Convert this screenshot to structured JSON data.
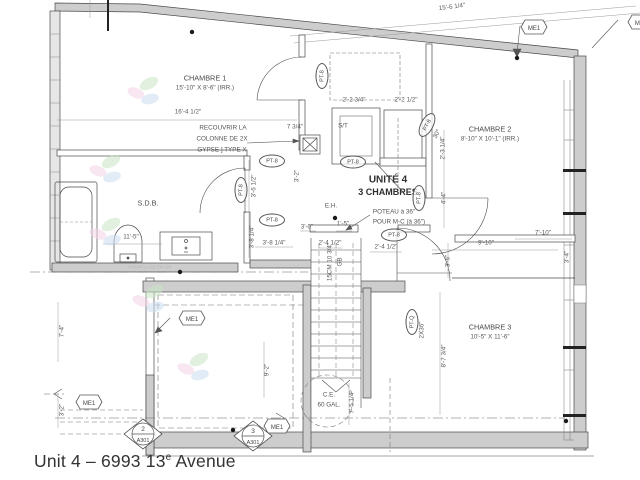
{
  "window": {
    "caption_prefix": "Unit 4 – 6993 13",
    "caption_sup": "e",
    "caption_suffix": " Avenue"
  },
  "plan": {
    "unit_title": "UNITÉ 4",
    "unit_subtitle": "3 CHAMBRES",
    "rooms": [
      {
        "name": "CHAMBRE 1",
        "dims": "15'-10\" X 8'-6\" (IRR.)"
      },
      {
        "name": "CHAMBRE 2",
        "dims": "8'-10\" X 10'-1\" (IRR.)"
      },
      {
        "name": "CHAMBRE 3",
        "dims": "10'-5\" X 11'-6\""
      },
      {
        "name": "S.D.B.",
        "dims": ""
      }
    ],
    "labels": {
      "eh": "E.H.",
      "st": "S/T",
      "soufflage": "SOUFFLAGE EN GB",
      "stair_note_1": "15CM 10 3/4\"",
      "stair_note_2": "GB",
      "angle_30": "30°"
    },
    "notes": {
      "recouvrir": [
        "RECOUVRIR LA",
        "COLONNE DE 2X",
        "GYPSE ] TYPE X"
      ],
      "poteau": [
        "POTEAU à 36\"",
        "POUR M-C (à 36\")"
      ],
      "chauffe_eau": [
        "C.E.",
        "60 GAL."
      ]
    },
    "dimensions": [
      "15'-6 1/4\"",
      "16'-4 1/2\"",
      "11'-5\"",
      "3'-8 1/4\"",
      "3'-8 1/4\"",
      "3'-6 1/2\"",
      "2'-2 3/4\"",
      "2'-2 1/2\"",
      "7 3/4\"",
      "3'-2\"",
      "2'-3 1/4\"",
      "4'-4\"",
      "2'-4 1/2\"",
      "2'-4 1/2\"",
      "3'-0\"",
      "1'-5\"",
      "9'-10\"",
      "7'-10\"",
      "3'-6\"",
      "3'-4\"",
      "8'-7 3/4\"",
      "7'-5 1/4\"",
      "7'-4\"",
      "3'-2\"",
      "9'-2\""
    ],
    "markers": {
      "pt8": "PT-8",
      "ptq": "PT-Q",
      "ptq2": "2X36\"",
      "me1": "ME1",
      "a301_2_num": "2",
      "a301_3_num": "3",
      "a301_sheet": "A301"
    }
  },
  "colors": {
    "line": "#4a4a4a",
    "wall_fill": "#cdcdcd",
    "dim_text": "#5a5a5a",
    "watermark_green": "#cbe7c6",
    "watermark_pink": "#f4d2e6",
    "watermark_blue": "#c9ddf2"
  }
}
